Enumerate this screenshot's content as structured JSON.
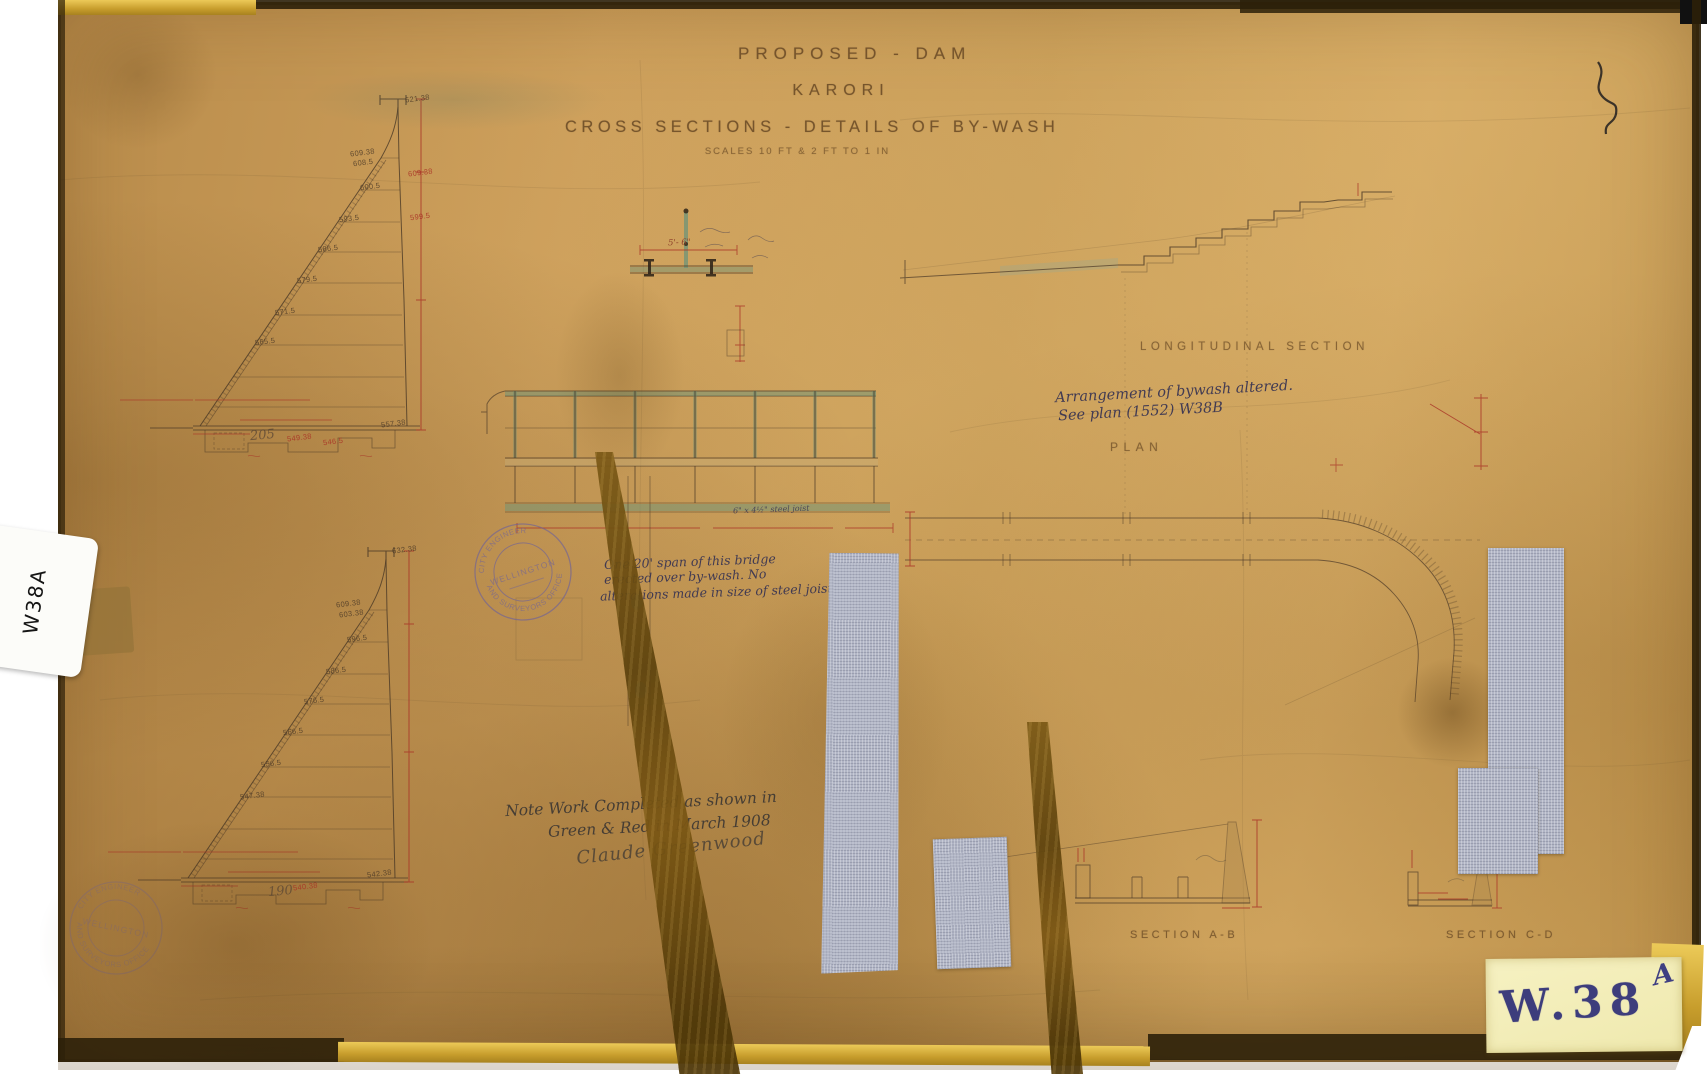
{
  "sheet": {
    "title_line1": "PROPOSED - DAM",
    "title_line2": "KARORI",
    "title_line3": "CROSS SECTIONS - DETAILS OF BY-WASH",
    "scale_line": "SCALES 10 FT & 2 FT TO 1 IN"
  },
  "section_labels": {
    "longitudinal": "LONGITUDINAL SECTION",
    "plan": "PLAN",
    "section_ab": "SECTION A-B",
    "section_cd": "SECTION C-D"
  },
  "notes": {
    "bywash_line1": "Arrangement of bywash altered.",
    "bywash_line2": "See plan (1552) W38B",
    "bridge_line1": "One 20' span of this bridge",
    "bridge_line2": "erected over by-wash. No",
    "bridge_line3": "alterations made in size of steel joists &c.",
    "completion_line1": "Note Work Completed as shown in",
    "completion_line2": "Green & Red in March 1908",
    "signature": "Claude Greenwood",
    "steel_joist": "6\" x 4½\" steel joist"
  },
  "dimensions": {
    "bridge_span": "5'- 6\""
  },
  "stamp": {
    "ring_top": "CITY ENGINEER",
    "ring_bottom": "AND SURVEYORS OFFICE",
    "center": "WELLINGTON"
  },
  "stickers": {
    "side_label": "W38A",
    "corner_code": "W.38",
    "corner_letter": "A"
  },
  "upper_section": {
    "station": "205",
    "elevations": [
      "621.38",
      "609.38",
      "608.5",
      "600.5",
      "593.5",
      "586.5",
      "579.5",
      "571.5",
      "565.5",
      "557.38"
    ],
    "red_elevations": [
      "609.38",
      "599.5",
      "549.38",
      "546.5"
    ]
  },
  "lower_section": {
    "station": "190",
    "elevations": [
      "632.38",
      "609.38",
      "603.38",
      "596.5",
      "586.5",
      "576.5",
      "566.5",
      "556.5",
      "547.38",
      "542.38"
    ],
    "red_elevations": [
      "540.38"
    ]
  }
}
